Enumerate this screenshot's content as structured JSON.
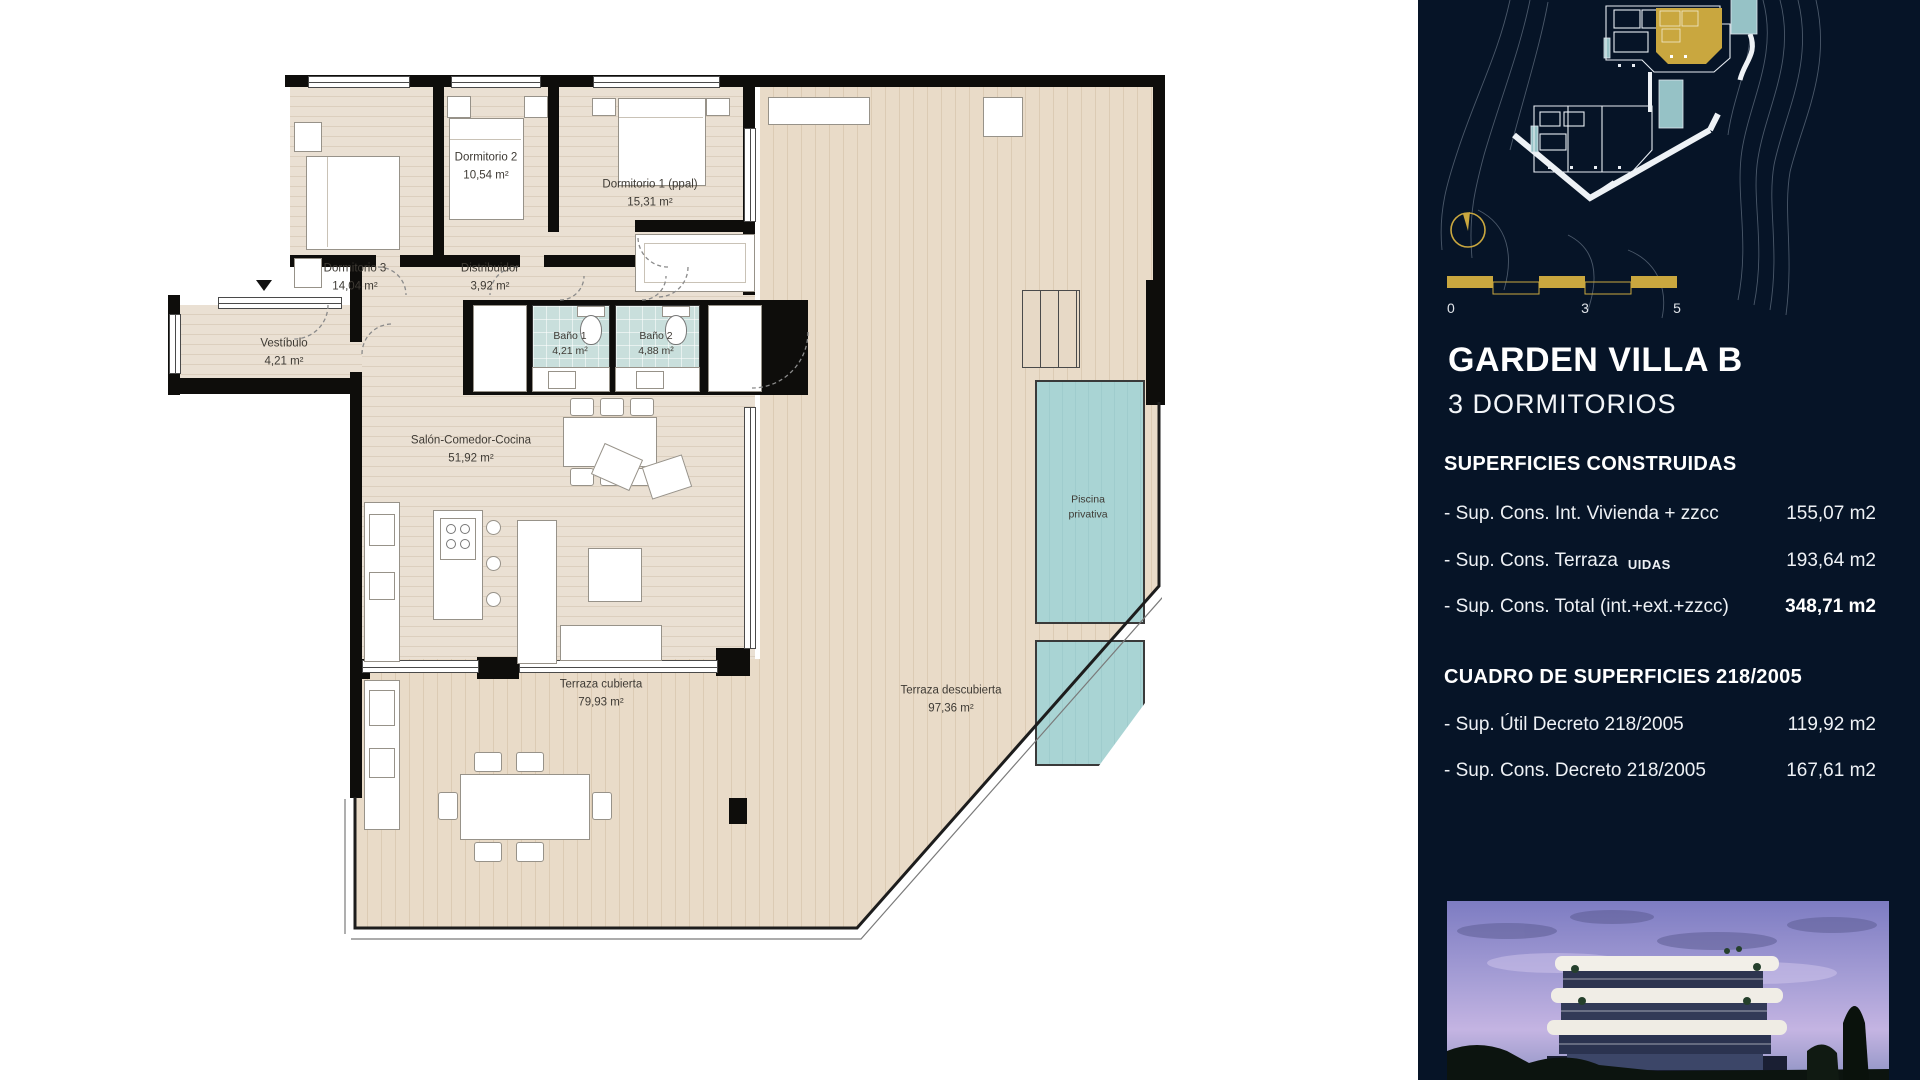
{
  "plan": {
    "entry_marker": "entrance",
    "rooms": [
      {
        "name": "Dormitorio 2",
        "area": "10,54 m²"
      },
      {
        "name": "Dormitorio 1 (ppal)",
        "area": "15,31 m²"
      },
      {
        "name": "Dormitorio 3",
        "area": "14,04 m²"
      },
      {
        "name": "Distribuidor",
        "area": "3,92 m²"
      },
      {
        "name": "Vestíbulo",
        "area": "4,21 m²"
      },
      {
        "name": "Baño 1",
        "area": "4,21 m²"
      },
      {
        "name": "Baño 2",
        "area": "4,88 m²"
      },
      {
        "name": "Salón-Comedor-Cocina",
        "area": "51,92 m²"
      },
      {
        "name": "Terraza cubierta",
        "area": "79,93 m²"
      },
      {
        "name": "Terraza descubierta",
        "area": "97,36 m²"
      },
      {
        "name": "Piscina privativa",
        "area": ""
      }
    ]
  },
  "sidebar": {
    "title": "GARDEN VILLA B",
    "subtitle": "3 DORMITORIOS",
    "scale": {
      "start": "0",
      "mid": "3",
      "end": "5"
    },
    "superficies": {
      "heading": "SUPERFICIES CONSTRUIDAS",
      "rows": [
        {
          "label": "- Sup. Cons. Int. Vivienda + zzcc",
          "value": "155,07 m2"
        },
        {
          "label": "- Sup. Cons. Terraza",
          "suffix": "UIDAS",
          "value": "193,64 m2"
        },
        {
          "label": "- Sup. Cons. Total (int.+ext.+zzcc)",
          "value": "348,71 m2"
        }
      ]
    },
    "cuadro": {
      "heading": "CUADRO DE SUPERFICIES 218/2005",
      "rows": [
        {
          "label": "- Sup. Útil Decreto 218/2005",
          "value": "119,92 m2"
        },
        {
          "label": "- Sup. Cons. Decreto 218/2005",
          "value": "167,61 m2"
        }
      ]
    }
  },
  "colors": {
    "sidebar_navy": "#061427",
    "accent_gold": "#c9a73f",
    "floor_beige": "#e9dfd2",
    "deck_beige": "#e8dac6",
    "bath_teal": "#c9dfdc",
    "pool_teal": "#a8d3d3"
  }
}
